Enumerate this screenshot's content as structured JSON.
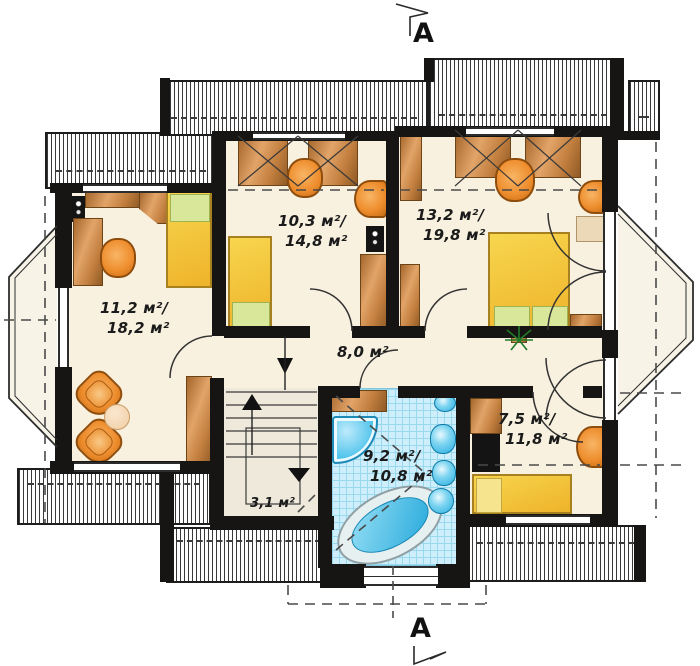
{
  "plan": {
    "title": "Attic floor plan",
    "section_marker_top": "A",
    "section_marker_bottom": "A",
    "rooms": [
      {
        "id": "bedroom-left",
        "line1": "11,2 м²/",
        "line2": "18,2 м²"
      },
      {
        "id": "bedroom-middle",
        "line1": "10,3 м²/",
        "line2": "14,8 м²"
      },
      {
        "id": "bedroom-right",
        "line1": "13,2 м²/",
        "line2": "19,8 м²"
      },
      {
        "id": "hallway",
        "line1": "8,0 м²",
        "line2": ""
      },
      {
        "id": "staircase",
        "line1": "3,1 м²",
        "line2": ""
      },
      {
        "id": "bathroom",
        "line1": "9,2 м²/",
        "line2": "10,8 м²"
      },
      {
        "id": "bedroom-small",
        "line1": "7,5 м²/",
        "line2": "11,8 м²"
      }
    ],
    "colors": {
      "wall": "#171513",
      "floor_cream": "#f8f1df",
      "wood": "#cd8843",
      "furniture_orange": "#ec8d2c",
      "bed_yellow": "#f2c237",
      "pillow_green": "#d9e79b",
      "bath_tile": "#cdeefa",
      "fixture_blue": "#2fb2e2"
    }
  }
}
